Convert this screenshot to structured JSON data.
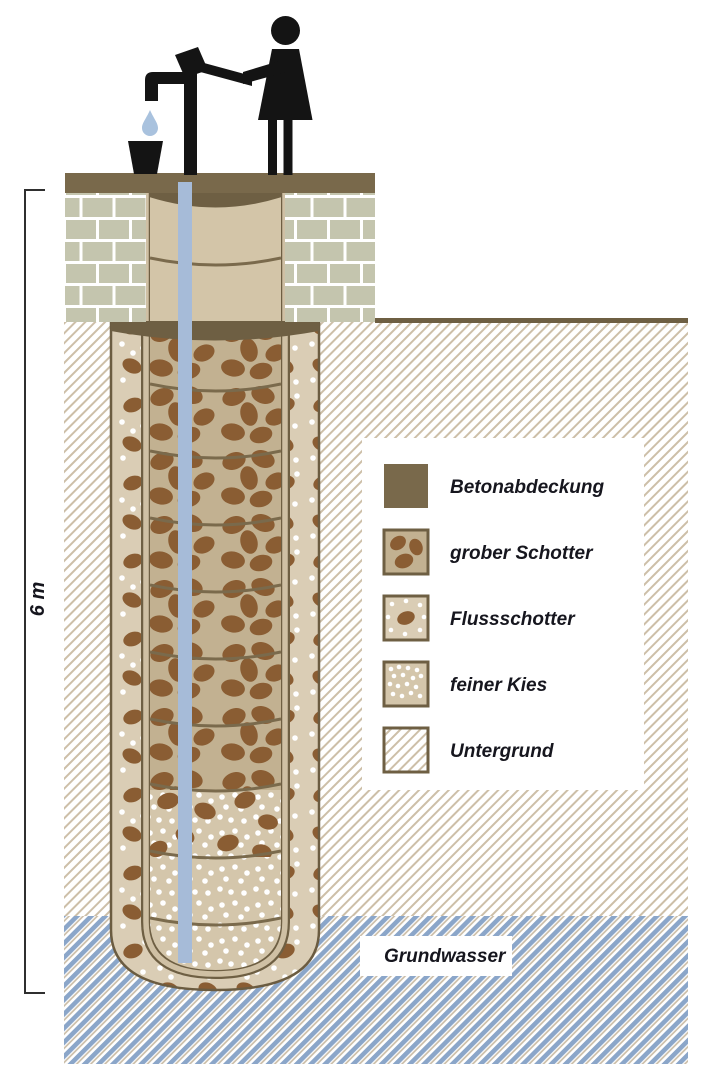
{
  "measurement": {
    "label": "6 m"
  },
  "groundwater": {
    "label": "Grundwasser"
  },
  "legend": {
    "items": [
      {
        "key": "betonabdeckung",
        "label": "Betonabdeckung",
        "swatch": "concrete-cover-swatch"
      },
      {
        "key": "grober-schotter",
        "label": "grober Schotter",
        "swatch": "coarse-gravel-swatch"
      },
      {
        "key": "flussschotter",
        "label": "Flussschotter",
        "swatch": "river-gravel-swatch"
      },
      {
        "key": "feiner-kies",
        "label": "feiner Kies",
        "swatch": "fine-gravel-swatch"
      },
      {
        "key": "untergrund",
        "label": "Untergrund",
        "swatch": "subsoil-hatch-swatch"
      }
    ]
  },
  "colors": {
    "concrete_brown": "#79694b",
    "outline_brown": "#6e5f43",
    "brick_grey": "#c4c5ae",
    "ring_tan": "#d3c5a8",
    "coarse_gravel_bg": "#c2b191",
    "river_gravel_bg": "#dacdb5",
    "fine_gravel_bg": "#d4c6ab",
    "stone_brown": "#8a5d33",
    "subsoil_hatch_tan": "#cdbfa8",
    "groundwater_blue": "#8ba6c9",
    "pipe_blue": "#a6bbd8",
    "drop_blue": "#a9c2de",
    "silhouette_black": "#141414",
    "text_dark": "#16161e"
  }
}
